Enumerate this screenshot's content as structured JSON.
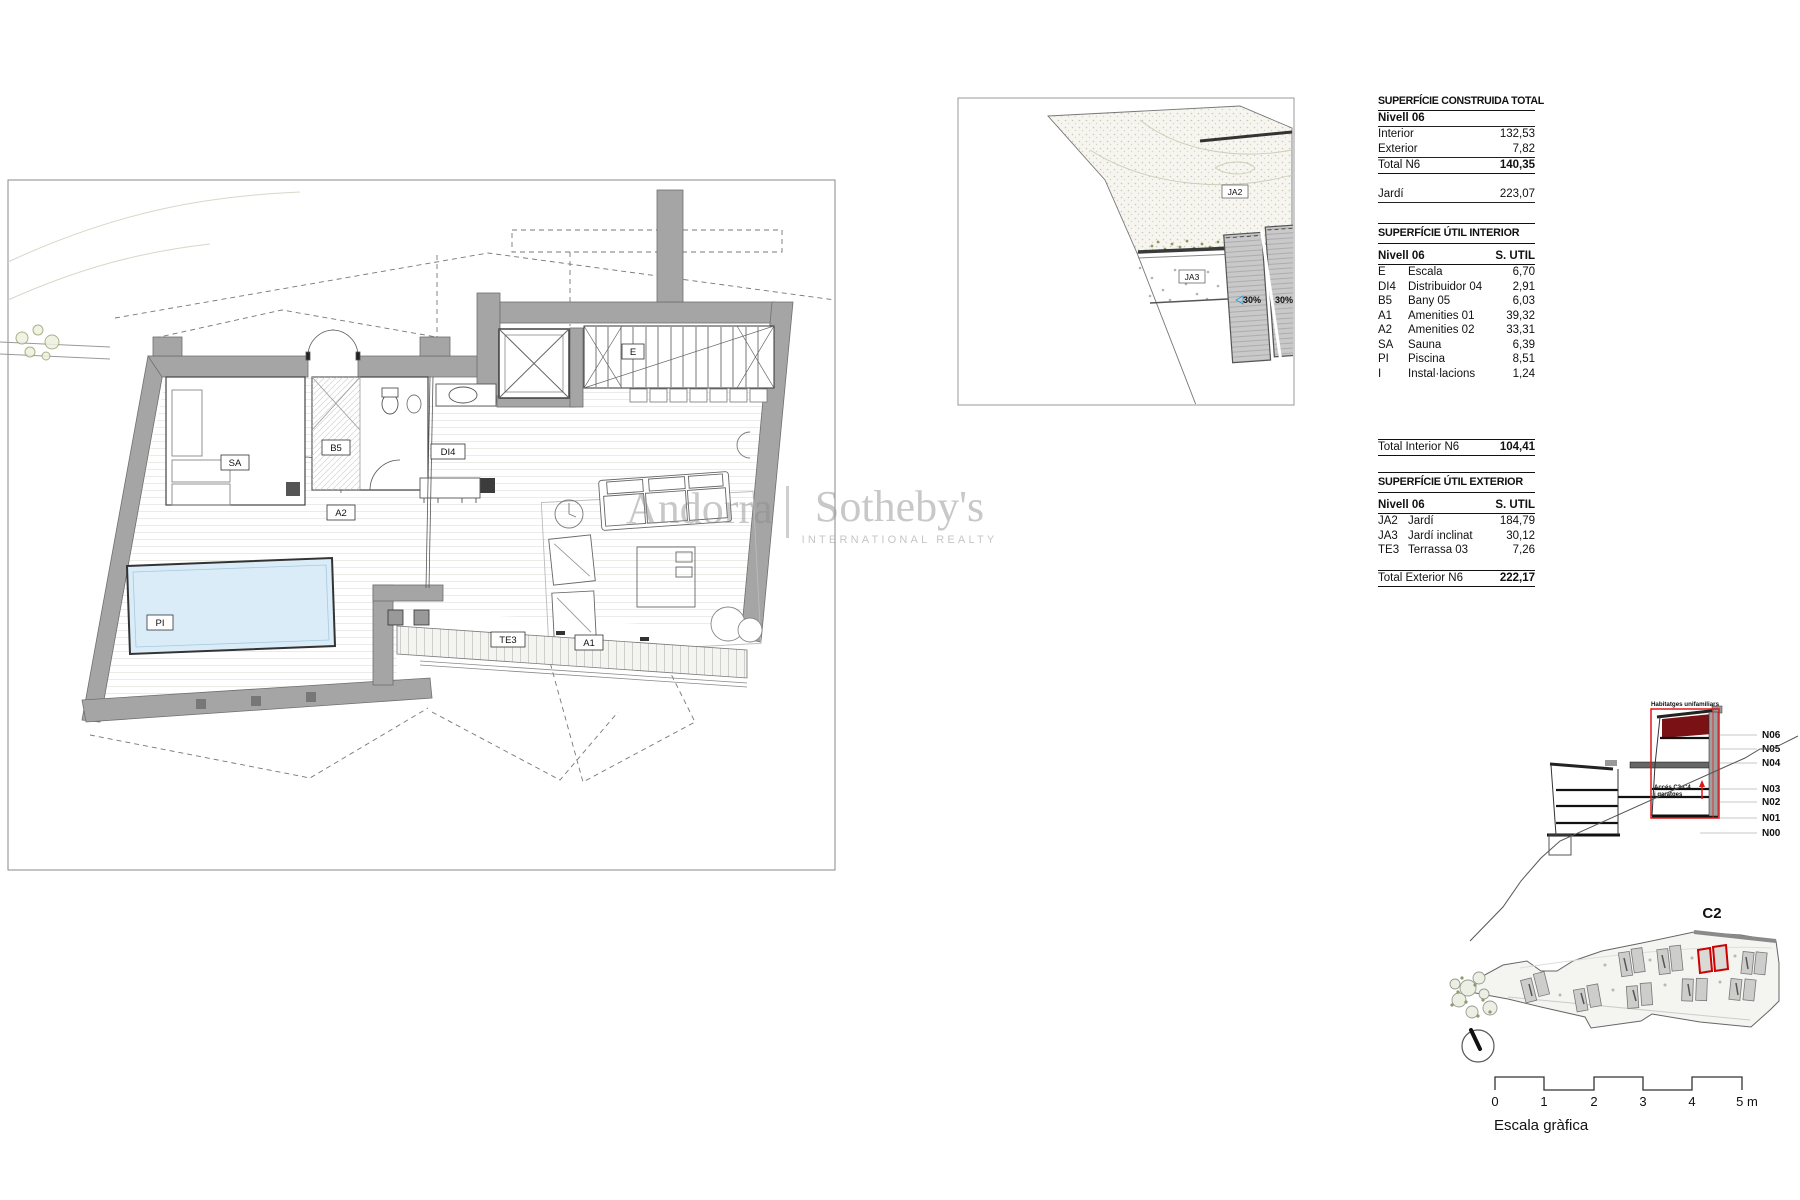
{
  "colors": {
    "annotation_red": "#e01818",
    "highlight_dark_red": "#7a1114",
    "unit_red": "#cc0000",
    "slope_blue": "#2d9fd4",
    "pool_blue": "#d9ecf8",
    "wall_gray": "#a5a5a5"
  },
  "watermark": {
    "brand_left": "Andorra",
    "brand_right": "Sotheby's",
    "subtitle": "INTERNATIONAL REALTY"
  },
  "plan": {
    "labels": {
      "sa": "SA",
      "b5": "B5",
      "di4": "DI4",
      "a2": "A2",
      "a1": "A1",
      "pi": "PI",
      "te3": "TE3",
      "e": "E"
    }
  },
  "inset": {
    "labels": {
      "ja2": "JA2",
      "ja3": "JA3"
    },
    "slope_label": "30%"
  },
  "tables": {
    "construida": {
      "title": "SUPERFÍCIE CONSTRUIDA TOTAL",
      "subheader": "Nivell 06",
      "rows": [
        {
          "label": "Interior",
          "value": "132,53"
        },
        {
          "label": "Exterior",
          "value": "7,82"
        }
      ],
      "total_label": "Total N6",
      "total_value": "140,35",
      "jardi_label": "Jardí",
      "jardi_value": "223,07"
    },
    "interior": {
      "title": "SUPERFÍCIE ÚTIL INTERIOR",
      "header_left": "Nivell 06",
      "header_right": "S. UTIL",
      "rows": [
        {
          "code": "E",
          "name": "Escala",
          "value": "6,70"
        },
        {
          "code": "DI4",
          "name": "Distribuidor 04",
          "value": "2,91"
        },
        {
          "code": "B5",
          "name": "Bany 05",
          "value": "6,03"
        },
        {
          "code": "A1",
          "name": "Amenities 01",
          "value": "39,32"
        },
        {
          "code": "A2",
          "name": "Amenities 02",
          "value": "33,31"
        },
        {
          "code": "SA",
          "name": "Sauna",
          "value": "6,39"
        },
        {
          "code": "PI",
          "name": "Piscina",
          "value": "8,51"
        },
        {
          "code": "I",
          "name": "Instal·lacions",
          "value": "1,24"
        }
      ],
      "total_label": "Total Interior N6",
      "total_value": "104,41"
    },
    "exterior": {
      "title": "SUPERFÍCIE ÚTIL EXTERIOR",
      "header_left": "Nivell 06",
      "header_right": "S. UTIL",
      "rows": [
        {
          "code": "JA2",
          "name": "Jardí",
          "value": "184,79"
        },
        {
          "code": "JA3",
          "name": "Jardí inclinat",
          "value": "30,12"
        },
        {
          "code": "TE3",
          "name": "Terrassa 03",
          "value": "7,26"
        }
      ],
      "total_label": "Total Exterior N6",
      "total_value": "222,17"
    }
  },
  "section": {
    "levels": [
      "N06",
      "N05",
      "N04",
      "N03",
      "N02",
      "N01",
      "N00"
    ],
    "top_label": "Habitatges unifamiliars",
    "access_label_line1": "Accés C3-C4",
    "access_label_line2": "i garatges"
  },
  "sitemap": {
    "unit_label": "C2"
  },
  "scalebar": {
    "ticks": [
      "0",
      "1",
      "2",
      "3",
      "4",
      "5 m"
    ],
    "caption": "Escala gràfica"
  }
}
